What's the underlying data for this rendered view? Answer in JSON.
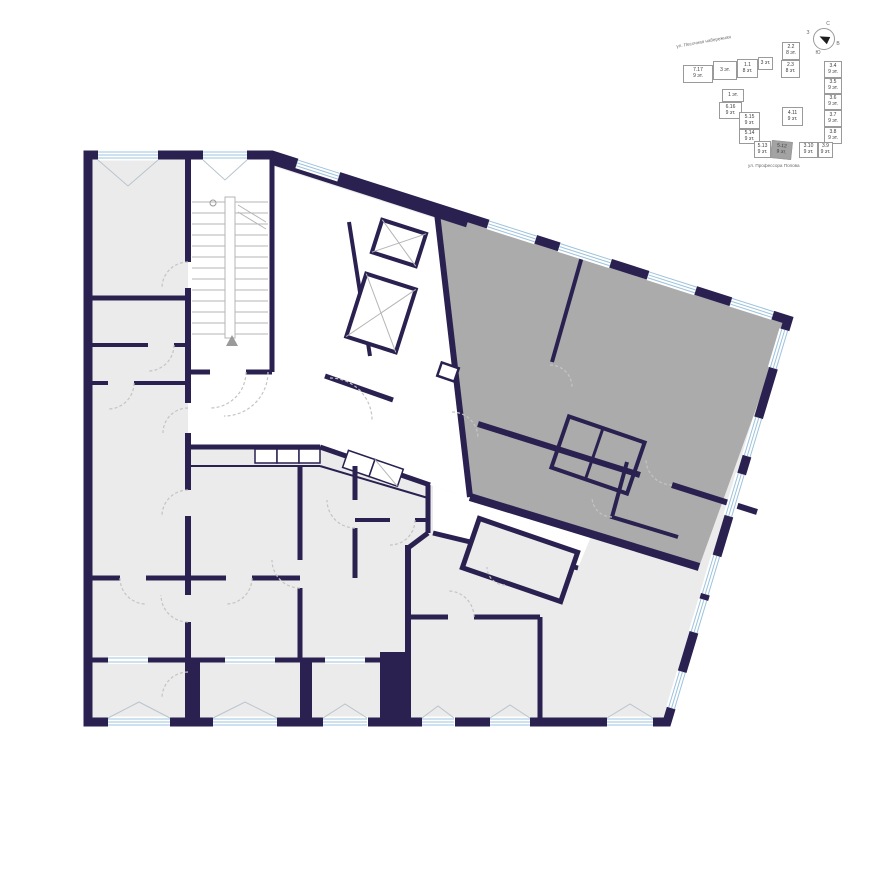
{
  "colors": {
    "wall": "#2a2150",
    "room": "#ebebeb",
    "selected": "#ababab",
    "window": "#9cc3dd",
    "door": "#c4c4c4",
    "street": "#6b6b6b",
    "text": "#3a3a3a",
    "minimap_border": "#9a9a9a",
    "minimap_selected": "#a3a3a3"
  },
  "minimap": {
    "streets": {
      "top": "ул. Песочная набережная",
      "right": "ул. Даля",
      "bottom": "ул. Профессора Попова"
    },
    "compass": {
      "north": "С",
      "east": "В",
      "south": "Ю",
      "west": "З"
    },
    "sections": [
      {
        "id": "7.17",
        "floors": "9 эт."
      },
      {
        "id": "3 эт.",
        "floors": ""
      },
      {
        "id": "1.1",
        "floors": "8 эт."
      },
      {
        "id": "3 эт.",
        "floors": ""
      },
      {
        "id": "2.2",
        "floors": "8 эт."
      },
      {
        "id": "2.3",
        "floors": "8 эт."
      },
      {
        "id": "1 эт.",
        "floors": ""
      },
      {
        "id": "6.16",
        "floors": "9 эт."
      },
      {
        "id": "5.15",
        "floors": "9 эт."
      },
      {
        "id": "5.14",
        "floors": "9 эт."
      },
      {
        "id": "5.13",
        "floors": "9 эт."
      },
      {
        "id": "5.12",
        "floors": "9 эт."
      },
      {
        "id": "4.11",
        "floors": "9 эт."
      },
      {
        "id": "3.4",
        "floors": "9 эт."
      },
      {
        "id": "3.5",
        "floors": "9 эт."
      },
      {
        "id": "3.6",
        "floors": "9 эт."
      },
      {
        "id": "3.7",
        "floors": "9 эт."
      },
      {
        "id": "3.8",
        "floors": "9 эт."
      },
      {
        "id": "3.10",
        "floors": "9 эт."
      },
      {
        "id": "3.9",
        "floors": "9 эт."
      }
    ],
    "selected_section": "5.12"
  }
}
